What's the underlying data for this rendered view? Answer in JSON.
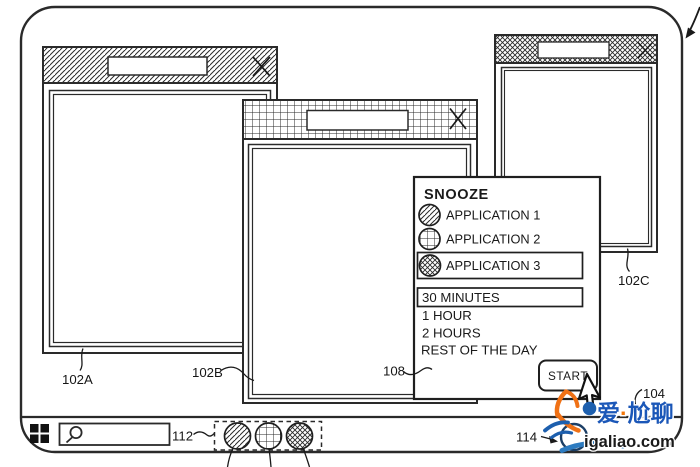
{
  "figure": {
    "type": "patent-style line drawing of a desktop UI with a snooze dialog",
    "line_color": "#1a1a1a",
    "background": "#ffffff"
  },
  "screen": {
    "description": "rounded-corner monitor screen outline with pointer reference arrow at top-right"
  },
  "windows": {
    "a": {
      "ref": "102A",
      "titlebar_pattern": "diagonal-hatch"
    },
    "b": {
      "ref": "102B",
      "titlebar_pattern": "square-grid-hatch"
    },
    "c": {
      "ref": "102C",
      "titlebar_pattern": "cross-diagonal-hatch"
    }
  },
  "dialog": {
    "ref": "108",
    "title": "SNOOZE",
    "applications": [
      {
        "label": "APPLICATION 1",
        "icon_pattern": "diagonal-hatch",
        "selected": false
      },
      {
        "label": "APPLICATION 2",
        "icon_pattern": "square-grid-hatch",
        "selected": false
      },
      {
        "label": "APPLICATION 3",
        "icon_pattern": "cross-diagonal-hatch",
        "selected": true
      }
    ],
    "durations": [
      {
        "label": "30 MINUTES",
        "selected": true
      },
      {
        "label": "1 HOUR",
        "selected": false
      },
      {
        "label": "2 HOURS",
        "selected": false
      },
      {
        "label": "REST OF THE DAY",
        "selected": false
      }
    ],
    "start_label": "START"
  },
  "taskbar": {
    "search_ref": "112",
    "tray_ref": "114",
    "icons": [
      {
        "name": "app-1-circle",
        "pattern": "diagonal-hatch"
      },
      {
        "name": "app-2-circle",
        "pattern": "square-grid-hatch"
      },
      {
        "name": "app-3-circle",
        "pattern": "cross-diagonal-hatch"
      }
    ]
  },
  "cursor": {
    "ref": "104",
    "type": "arrow-pointer"
  },
  "icons": {
    "close": "X-cross",
    "search": "magnifier",
    "start_menu": "four-square-grid"
  },
  "labels": {
    "window_a": "102A",
    "window_b": "102B",
    "window_c": "102C",
    "dialog": "108",
    "taskbar_apps": "112",
    "tray": "114",
    "cursor": "104"
  },
  "watermark": {
    "cn_part1": "爱",
    "cn_dot": "·",
    "cn_part2": "尬聊",
    "site": "igaliao.com",
    "blue": "#1b57b8",
    "orange": "#f2760a"
  }
}
